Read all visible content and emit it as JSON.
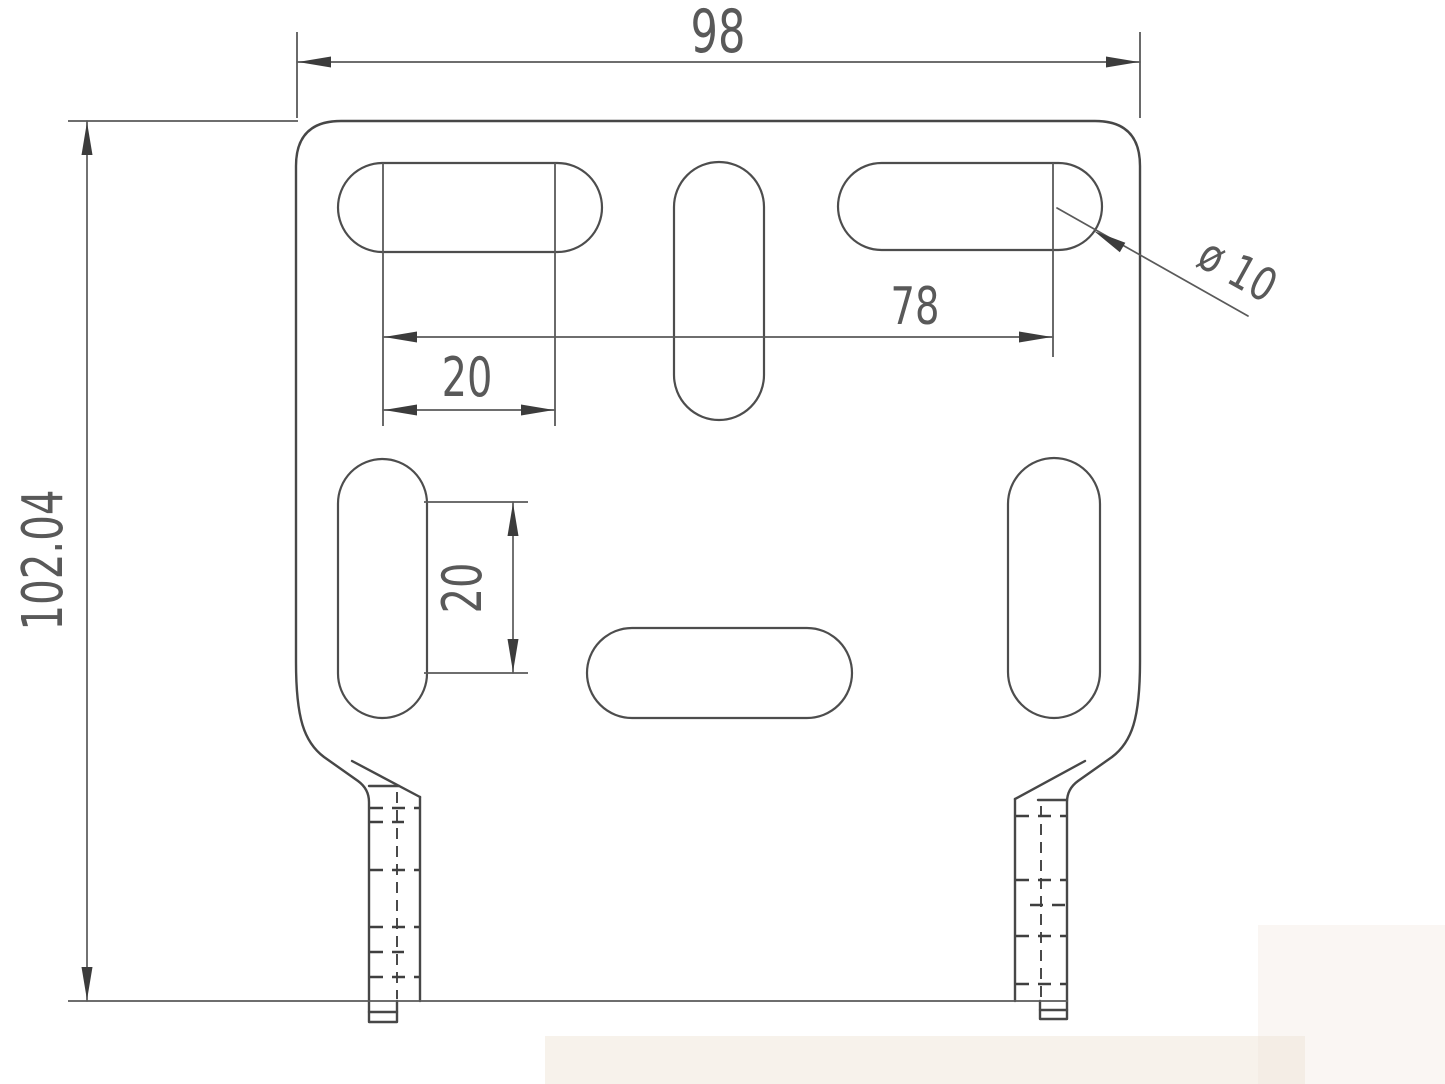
{
  "drawing": {
    "type": "technical-drawing",
    "subject": "sheet-metal mounting bracket, front view",
    "units_implied": "mm",
    "dims": {
      "overall_width": "98",
      "overall_height": "102.04",
      "hole_span": "78",
      "top_slot_pitch": "20",
      "side_slot_pitch": "20",
      "hole_diameter": "ø 10"
    },
    "features": {
      "slot_count": 6,
      "slot_shape": "stadium / obround",
      "legs": 2
    },
    "colors": {
      "background": "#ffffff",
      "line": "#474747",
      "dimension_line": "#5a5a5a",
      "text": "#595959"
    }
  }
}
